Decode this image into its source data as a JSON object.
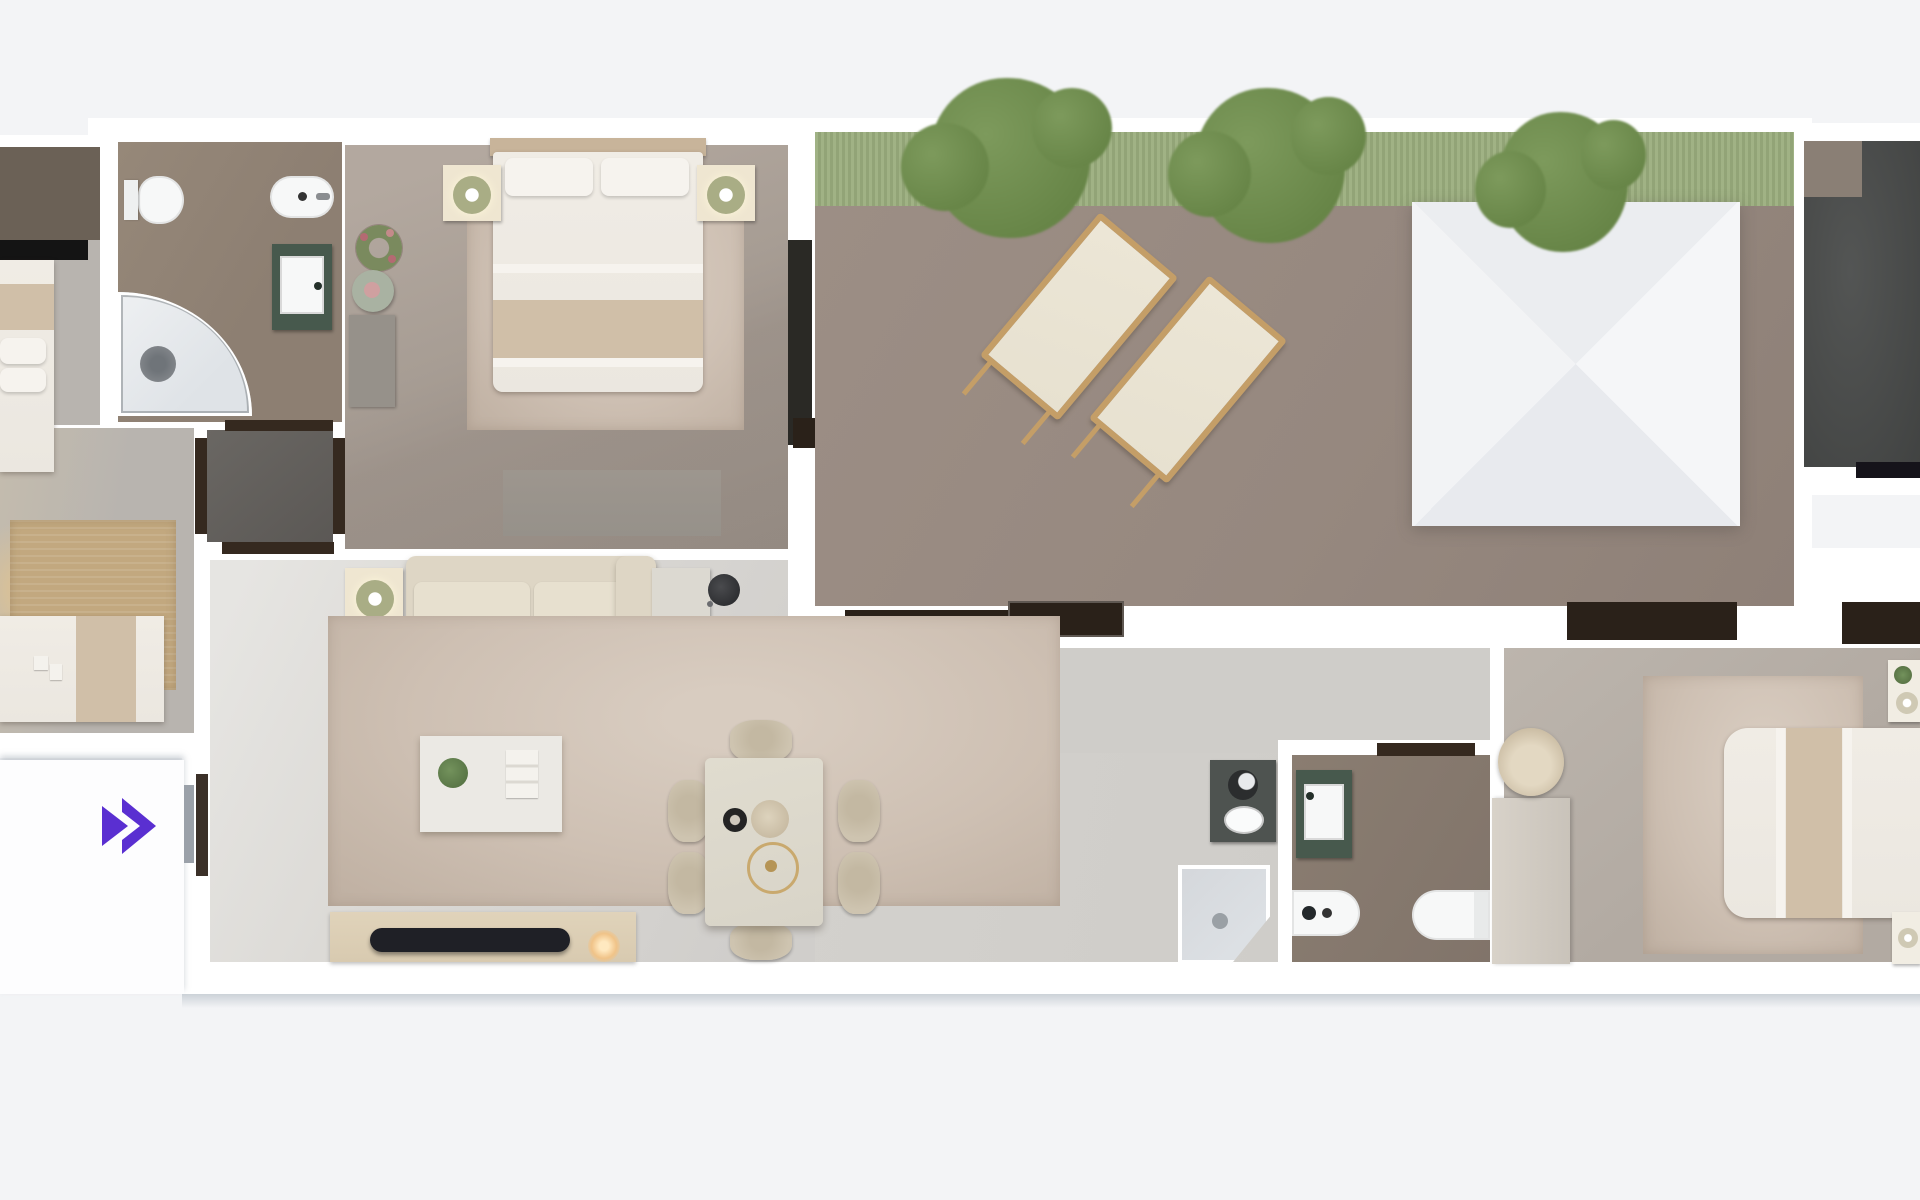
{
  "view": {
    "description": "Top-down 3D rendered apartment floor plan",
    "overlay_control": {
      "icon": "fast-forward-double-chevron",
      "purpose": "expand / next",
      "color": "#5a2fd1"
    }
  },
  "palette": {
    "bg": "#f3f4f6",
    "wall": "#ffffff",
    "wall_shadow": "#ccd2d8",
    "bath_floor": "#8d7f72",
    "bath2_floor": "#81746a",
    "bedroom1_floor": "#a79d94",
    "bedroom2_floor": "#b2aaa2",
    "leftroom_floor": "#b8b4af",
    "vestibule_floor": "#5b5855",
    "doorframe_dark": "#35291f",
    "window_dark": "#2a2119",
    "terrace_floor": "#96887f",
    "grass": "#9aad7d",
    "tree": "#678547",
    "tree_light": "#7d9a5c",
    "darkroom_floor": "#4a4c4b",
    "interior_floor": "#dbd9d5",
    "corridor_floor": "#cfcdc9",
    "rug": "#cec0b3",
    "rug_tan": "#c2a87f",
    "sofa": "#ded6c5",
    "cushion": "#e7e0cf",
    "cream_furniture": "#efe6d1",
    "lamp_shade": "#a9ad85",
    "table": "#d8d4c8",
    "chair": "#cec4b0",
    "console": "#d8cab0",
    "tv": "#1f2026",
    "glow": "#f0c388",
    "bed_white": "#ebe7e0",
    "bed_stripe": "#d0bfa8",
    "headboard": "#c8b49a",
    "wardrobe_dark": "#6b6156",
    "dresser": "#96918a",
    "vanity_green": "#47594d",
    "fixture_white": "#f7f8f8",
    "shower_glass": "#dfe3e7",
    "counter_dark": "#4e5350",
    "canopy": "#f1f2f5",
    "wood": "#c49e67",
    "lounger_cushion": "#e7e1d0",
    "accent": "#5a2fd1",
    "door_leaf": "#9ba1a9",
    "black": "#141414",
    "gold": "#c9a96e"
  },
  "scene": {
    "rooms": [
      {
        "name": "bathroom-1",
        "fixtures": [
          "toilet",
          "bidet",
          "green-vanity-sink",
          "corner-shower"
        ]
      },
      {
        "name": "bedroom-1",
        "furniture": [
          "double-bed",
          "nightstand-left",
          "nightstand-right",
          "table-lamps",
          "rug",
          "wardrobe",
          "dresser",
          "wreath",
          "side-table"
        ]
      },
      {
        "name": "vestibule",
        "furniture": []
      },
      {
        "name": "terrace",
        "furniture": [
          "grass-planter",
          "tree",
          "tree",
          "tree",
          "sun-lounger",
          "sun-lounger",
          "white-canopy"
        ]
      },
      {
        "name": "media-room-partial",
        "furniture": []
      },
      {
        "name": "living-dining",
        "furniture": [
          "sofa",
          "chaise",
          "side-tables",
          "floor-lamp",
          "rug",
          "coffee-table",
          "plant",
          "books",
          "tv-console",
          "tv",
          "dining-table",
          "six-chairs",
          "pendant-ring"
        ]
      },
      {
        "name": "kitchen-nook",
        "fixtures": [
          "dark-counter",
          "round-basin",
          "oval-sink",
          "corner-shower"
        ]
      },
      {
        "name": "bathroom-2",
        "fixtures": [
          "green-vanity-sink",
          "bidet",
          "toilet"
        ]
      },
      {
        "name": "bedroom-2",
        "furniture": [
          "double-bed",
          "nightstands",
          "rug",
          "desk",
          "round-chair",
          "wardrobe-strip"
        ]
      },
      {
        "name": "bedroom-3-partial",
        "furniture": [
          "bed",
          "wardrobe",
          "tan-rug",
          "single-bed"
        ]
      },
      {
        "name": "entry-platform",
        "furniture": [
          "door"
        ]
      }
    ]
  }
}
